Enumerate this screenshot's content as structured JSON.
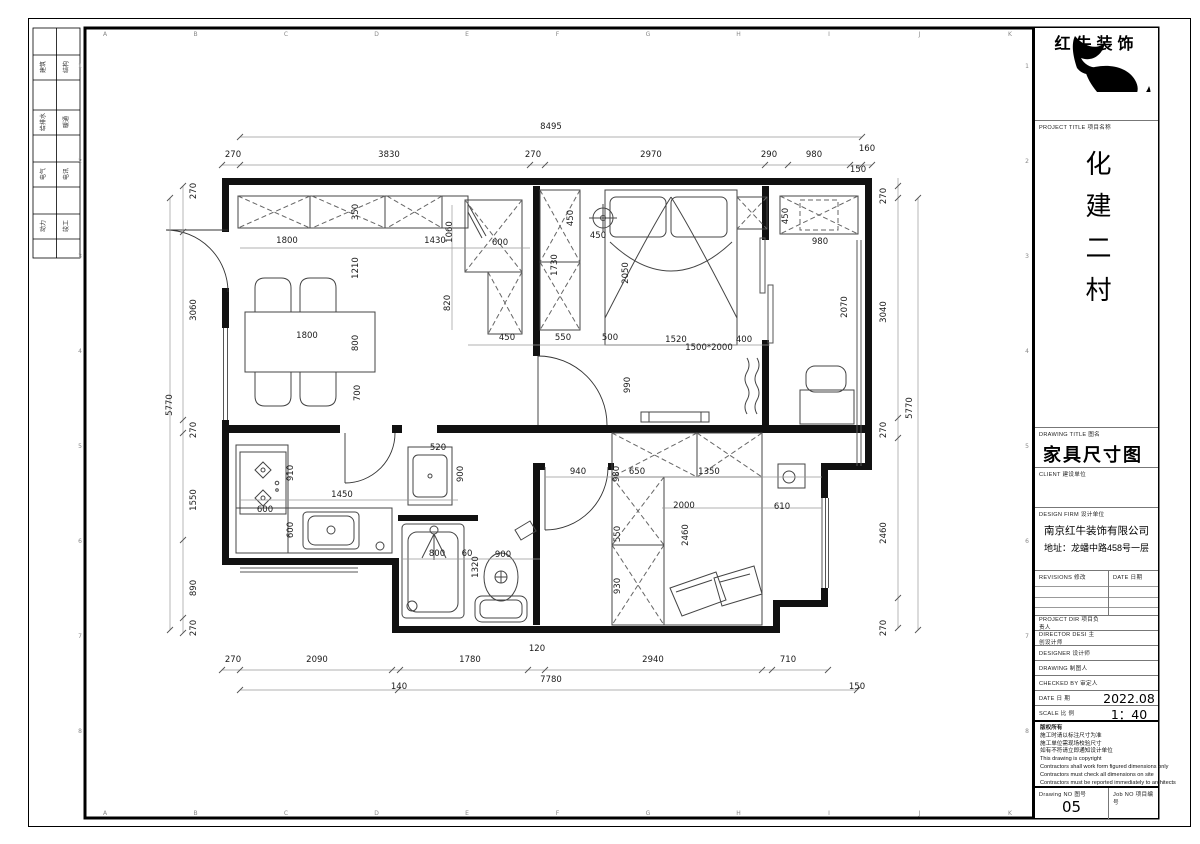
{
  "sheet": {
    "ruler_letters": [
      "A",
      "B",
      "C",
      "D",
      "E",
      "F",
      "G",
      "H",
      "I",
      "J",
      "K"
    ],
    "ruler_numbers": [
      "1",
      "2",
      "3",
      "4",
      "5",
      "6",
      "7",
      "8"
    ],
    "stamp_rows": [
      [
        "建筑",
        "结构"
      ],
      [
        "给排水",
        "暖通"
      ],
      [
        "电气",
        "电讯"
      ],
      [
        "动力",
        "竣工"
      ]
    ]
  },
  "title_block": {
    "logo_text": "红牛装饰",
    "project_title_label": "PROJECT TITLE   项目名称",
    "project_name": "化建二村",
    "drawing_title_label": "DRAWING TITLE   图名",
    "drawing_title": "家具尺寸图",
    "client_label": "CLIENT   建设单位",
    "design_firm_label": "DESIGN FIRM   设计单位",
    "company": "南京红牛装饰有限公司",
    "address": "地址：龙蟠中路458号一层",
    "revisions_label": "REVISIONS   修改",
    "date_col_label": "DATE   日期",
    "info_rows": [
      {
        "label": "PROJECT DIR   项目负责人",
        "value": ""
      },
      {
        "label": "DIRECTOR DESI   主创设计师",
        "value": ""
      },
      {
        "label": "DESIGNER   设计师",
        "value": ""
      },
      {
        "label": "DRAWING   制图人",
        "value": ""
      },
      {
        "label": "CHECKED BY   审定人",
        "value": ""
      },
      {
        "label": "DATE   日 期",
        "value": "2022.08"
      },
      {
        "label": "SCALE   比 例",
        "value": "1：40"
      }
    ],
    "copyright_lines": [
      "版权所有",
      "施工时请以标注尺寸为准",
      "施工单位需现场校验尺寸",
      "如有不符请立即通知设计单位",
      "This drawing is copyright",
      "Contractors shall work form figured dimensions only",
      "Contractors must check all dimensions on site",
      "Contractors must be reported immediately to architects"
    ],
    "drawing_no_label": "Drawing NO   图号",
    "drawing_no": "05",
    "job_no_label": "Job NO   项目编号"
  },
  "plan": {
    "dim_labels": [
      [
        551,
        129,
        "8495",
        0
      ],
      [
        233,
        157,
        "270",
        0
      ],
      [
        389,
        157,
        "3830",
        0
      ],
      [
        533,
        157,
        "270",
        0
      ],
      [
        651,
        157,
        "2970",
        0
      ],
      [
        769,
        157,
        "290",
        0
      ],
      [
        814,
        157,
        "980",
        0
      ],
      [
        867,
        151,
        "160",
        0
      ],
      [
        858,
        172,
        "150",
        0
      ],
      [
        196,
        191,
        "270",
        1
      ],
      [
        196,
        310,
        "3060",
        1
      ],
      [
        196,
        430,
        "270",
        1
      ],
      [
        196,
        500,
        "1550",
        1
      ],
      [
        196,
        588,
        "890",
        1
      ],
      [
        196,
        628,
        "270",
        1
      ],
      [
        172,
        405,
        "5770",
        1
      ],
      [
        886,
        196,
        "270",
        1
      ],
      [
        886,
        312,
        "3040",
        1
      ],
      [
        886,
        430,
        "270",
        1
      ],
      [
        886,
        533,
        "2460",
        1
      ],
      [
        886,
        628,
        "270",
        1
      ],
      [
        912,
        408,
        "5770",
        1
      ],
      [
        233,
        662,
        "270",
        0
      ],
      [
        317,
        662,
        "2090",
        0
      ],
      [
        470,
        662,
        "1780",
        0
      ],
      [
        537,
        651,
        "120",
        0
      ],
      [
        653,
        662,
        "2940",
        0
      ],
      [
        788,
        662,
        "710",
        0
      ],
      [
        551,
        682,
        "7780",
        0
      ],
      [
        399,
        689,
        "140",
        0
      ],
      [
        857,
        689,
        "150",
        0
      ],
      [
        358,
        212,
        "350",
        1
      ],
      [
        287,
        243,
        "1800",
        0
      ],
      [
        435,
        243,
        "1430",
        0
      ],
      [
        452,
        232,
        "1060",
        1
      ],
      [
        358,
        268,
        "1210",
        1
      ],
      [
        450,
        303,
        "820",
        1
      ],
      [
        307,
        338,
        "1800",
        0
      ],
      [
        358,
        343,
        "800",
        1
      ],
      [
        360,
        393,
        "700",
        1
      ],
      [
        500,
        245,
        "600",
        0
      ],
      [
        573,
        218,
        "450",
        1
      ],
      [
        598,
        238,
        "450",
        0
      ],
      [
        557,
        265,
        "1730",
        1
      ],
      [
        628,
        273,
        "2050",
        1
      ],
      [
        507,
        340,
        "450",
        0
      ],
      [
        563,
        340,
        "550",
        0
      ],
      [
        610,
        340,
        "500",
        0
      ],
      [
        676,
        342,
        "1520",
        0
      ],
      [
        709,
        350,
        "1500*2000",
        0
      ],
      [
        744,
        342,
        "400",
        0
      ],
      [
        630,
        385,
        "990",
        1
      ],
      [
        788,
        216,
        "450",
        1
      ],
      [
        820,
        244,
        "980",
        0
      ],
      [
        847,
        307,
        "2070",
        1
      ],
      [
        438,
        450,
        "520",
        0
      ],
      [
        293,
        473,
        "910",
        1
      ],
      [
        463,
        474,
        "900",
        1
      ],
      [
        342,
        497,
        "1450",
        0
      ],
      [
        265,
        512,
        "600",
        0
      ],
      [
        293,
        530,
        "600",
        1
      ],
      [
        437,
        556,
        "800",
        0
      ],
      [
        467,
        556,
        "60",
        0
      ],
      [
        503,
        557,
        "900",
        0
      ],
      [
        478,
        567,
        "1320",
        1
      ],
      [
        578,
        474,
        "940",
        0
      ],
      [
        619,
        474,
        "980",
        1
      ],
      [
        637,
        474,
        "650",
        0
      ],
      [
        709,
        474,
        "1350",
        0
      ],
      [
        684,
        508,
        "2000",
        0
      ],
      [
        782,
        509,
        "610",
        0
      ],
      [
        688,
        535,
        "2460",
        1
      ],
      [
        620,
        534,
        "550",
        1
      ],
      [
        620,
        586,
        "930",
        1
      ]
    ]
  }
}
